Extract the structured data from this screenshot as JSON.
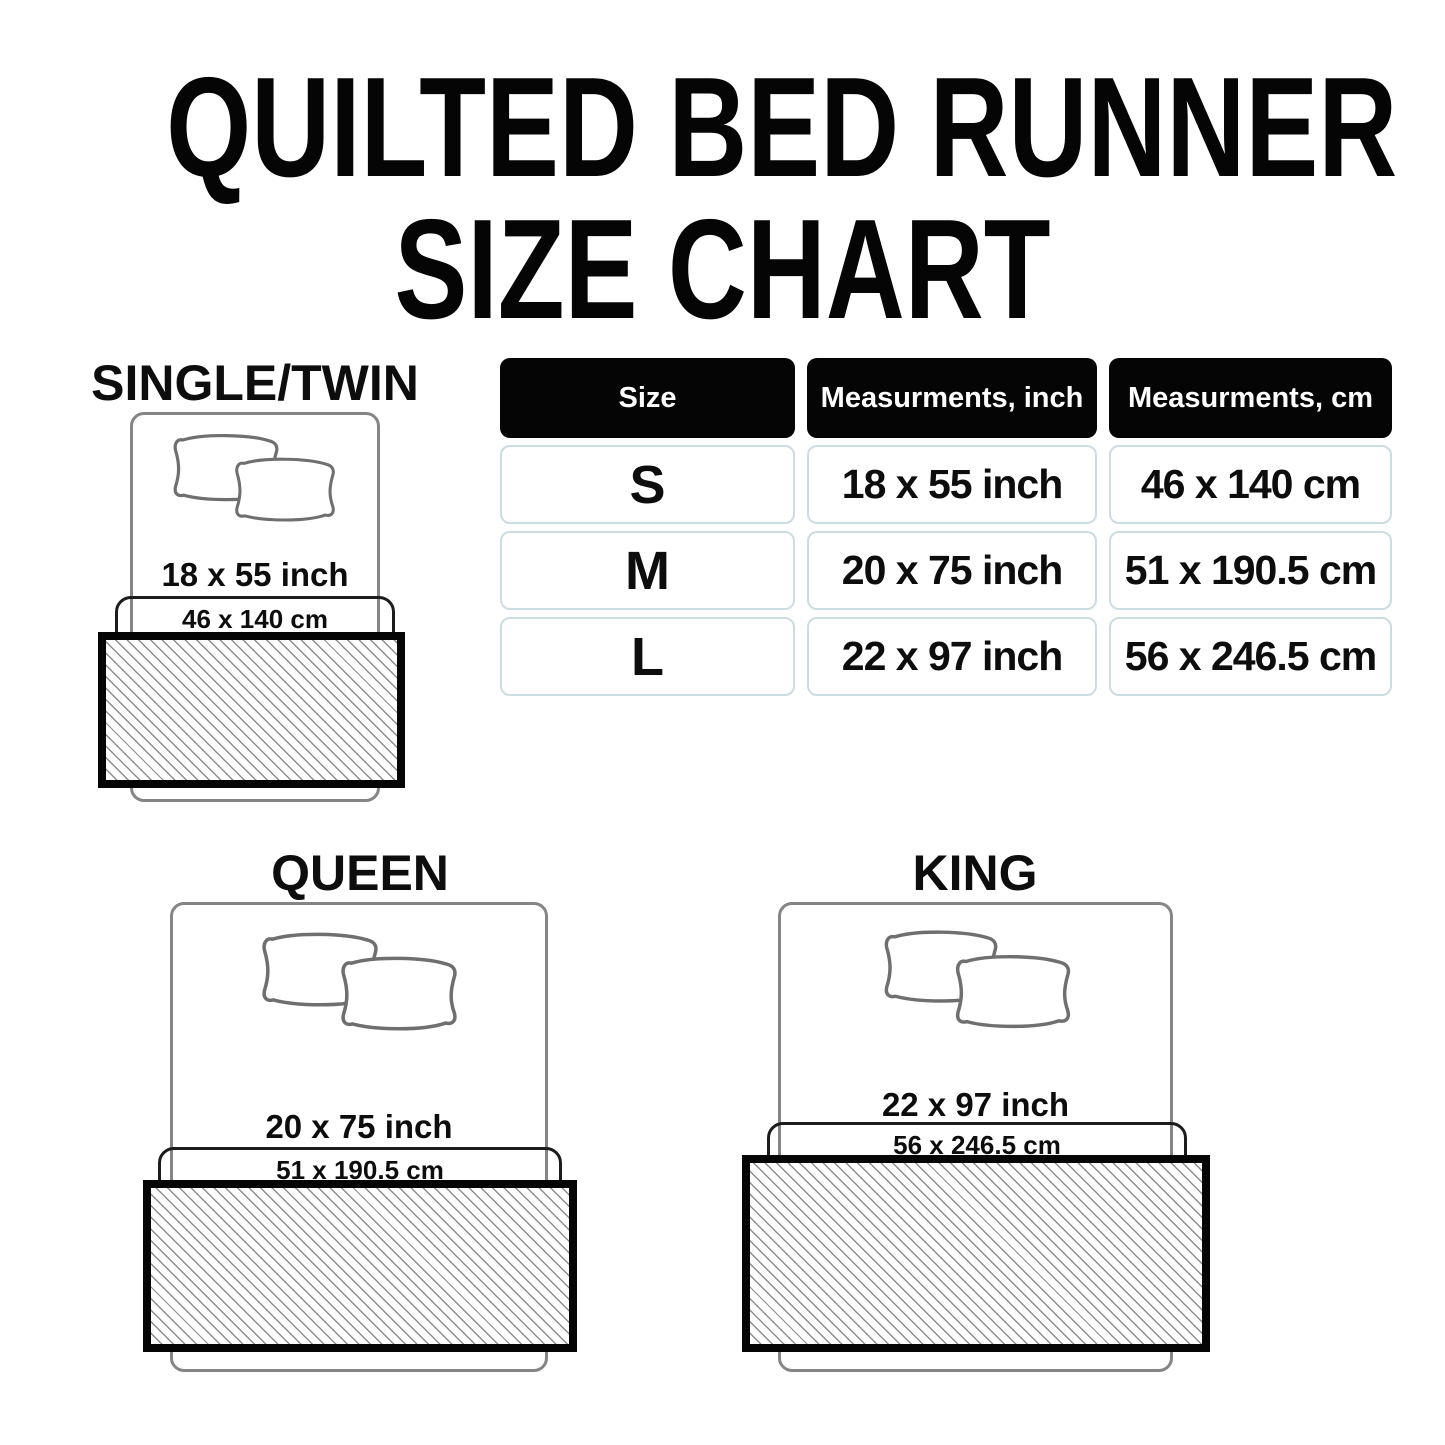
{
  "title": {
    "line1": "QUILTED BED RUNNER",
    "line2": "SIZE CHART"
  },
  "table": {
    "headers": [
      "Size",
      "Measurments, inch",
      "Measurments, cm"
    ],
    "rows": [
      {
        "size": "S",
        "inch": "18 x 55 inch",
        "cm": "46 x 140 cm"
      },
      {
        "size": "M",
        "inch": "20 x 75 inch",
        "cm": "51 x 190.5 cm"
      },
      {
        "size": "L",
        "inch": "22 x 97 inch",
        "cm": "56 x 246.5 cm"
      }
    ]
  },
  "diagrams": [
    {
      "id": "single-twin",
      "label": "SINGLE/TWIN",
      "inch": "18 x 55 inch",
      "cm": "46 x 140 cm"
    },
    {
      "id": "queen",
      "label": "QUEEN",
      "inch": "20 x 75 inch",
      "cm": "51 x 190.5 cm"
    },
    {
      "id": "king",
      "label": "KING",
      "inch": "22 x 97 inch",
      "cm": "56 x 246.5 cm"
    }
  ],
  "colors": {
    "background": "#ffffff",
    "text": "#0d0d0d",
    "header_bg": "#050505",
    "header_text": "#ffffff",
    "cell_border": "#cbdde1",
    "bed_outline": "#858585",
    "pillow_outline": "#6f6f6f",
    "band_outline": "#1c1c1c",
    "runner_border": "#050505",
    "hatch_line": "#8d8d8d"
  }
}
